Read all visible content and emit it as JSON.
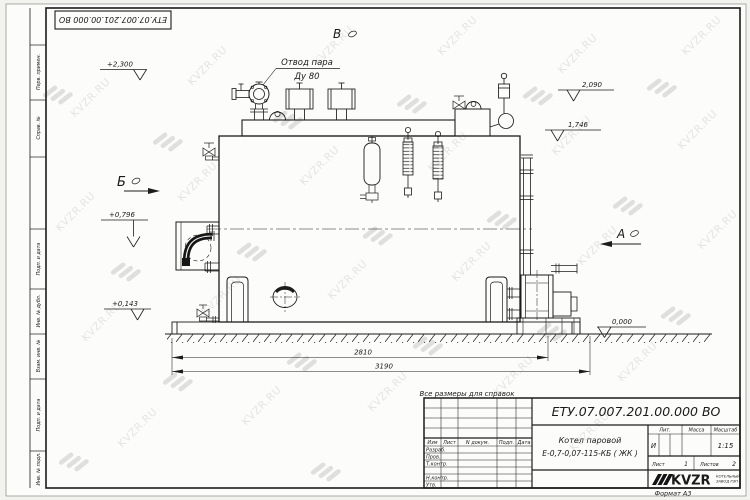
{
  "watermark": {
    "text": "KVZR.RU"
  },
  "top_stamp": {
    "designation": "ЕТУ.07.007.201.00.000 ВО"
  },
  "margin": {
    "perv": "Перв. примен.",
    "sprav": "Справ. №",
    "podp1": "Подп. и дата",
    "inv_dubl": "Инв. № дубл.",
    "vzam": "Взам. инв. №",
    "podp2": "Подп. и дата",
    "inv_podl": "Инв. № подл."
  },
  "drawing": {
    "steam_outlet": {
      "line1": "Отвод пара",
      "line2": "Ду 80"
    },
    "views": {
      "a": "А",
      "b": "Б",
      "v": "В"
    },
    "elevations": {
      "e1": "+2,300",
      "e2": "2,090",
      "e3": "1,746",
      "e4": "+0,796",
      "e5": "+0,143",
      "e6": "0,000"
    },
    "dims": {
      "d1": "2810",
      "d2": "3190"
    }
  },
  "note": {
    "text": "Все размеры для справок"
  },
  "title_block": {
    "designation": "ЕТУ.07.007.201.00.000 ВО",
    "name1": "Котел паровой",
    "name2": "Е-0,7-0,07-115-КБ ( ЖК )",
    "cols": {
      "izm": "Изм",
      "list": "Лист",
      "doc": "N докум.",
      "podp": "Подп.",
      "data": "Дата"
    },
    "rows": {
      "razrab": "Разраб.",
      "prov": "Пров.",
      "tkontr": "Т.контр.",
      "nkontr": "Н.контр.",
      "utv": "Утв."
    },
    "lit": {
      "label": "Лит.",
      "value": "И"
    },
    "massa": {
      "label": "Масса"
    },
    "scale": {
      "label": "Масштаб",
      "value": "1:15"
    },
    "sheet": {
      "label": "Лист",
      "value": "1"
    },
    "sheets": {
      "label": "Листов",
      "value": "2"
    },
    "company": {
      "logo": "KVZR",
      "sub1": "КОТЕЛЬНЫЙ",
      "sub2": "ЗАВОД РЭП"
    },
    "format": "Формат А3"
  }
}
